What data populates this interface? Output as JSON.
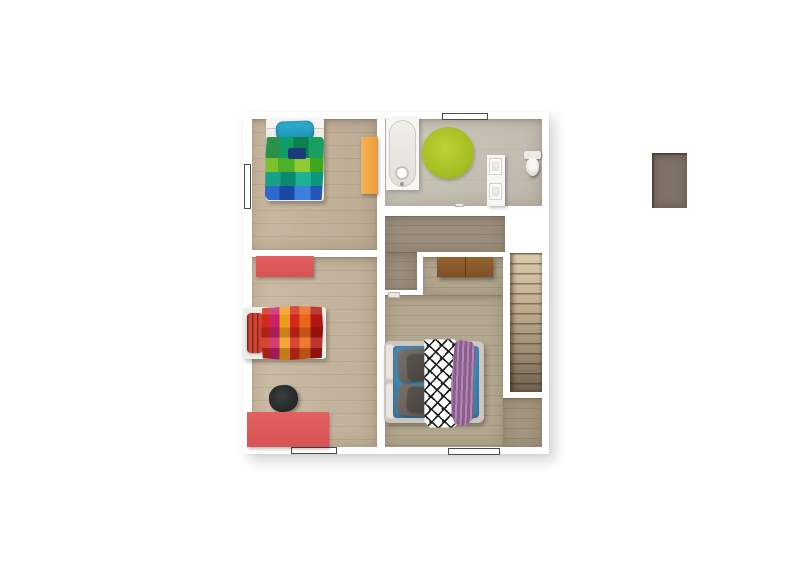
{
  "scene": {
    "description": "3D top-down architectural floor plan rendering of an upper storey, no visible text labels",
    "background_color": "#ffffff",
    "wall_color": "#ffffff",
    "rooms": [
      {
        "id": "bedroom-top-left",
        "floor_color": "#c5b49b",
        "furniture": [
          "single bed with blue-green plaid duvet",
          "teal pillow",
          "orange dresser"
        ],
        "windows": [
          "left wall"
        ]
      },
      {
        "id": "bathroom-top-right",
        "floor_color": "#c9c2b5",
        "toilet_nook_color": "#7e7268",
        "furniture": [
          "bathtub",
          "lime-green round rug",
          "double-basin vanity",
          "toilet"
        ],
        "windows": [
          "top wall"
        ]
      },
      {
        "id": "bedroom-bottom-left",
        "floor_color": "#c9b8a0",
        "furniture": [
          "bed with red-orange-magenta plaid duvet",
          "red pillow",
          "coral dresser",
          "coral desk",
          "black chair"
        ],
        "windows": [
          "bottom wall"
        ]
      },
      {
        "id": "hallway-landing",
        "floor_color": "#9a8e7c",
        "furniture": []
      },
      {
        "id": "master-bedroom-bottom-right",
        "floor_color": "#b3a78f",
        "furniture": [
          "double bed with blue duvet",
          "gray pillows",
          "black-white diamond runner",
          "purple chunky throw",
          "wooden chest"
        ],
        "windows": [
          "bottom wall"
        ]
      },
      {
        "id": "staircase-right",
        "tread_count": 14,
        "tread_colors": [
          "#ddcbad",
          "#6e604f"
        ]
      }
    ],
    "palette": {
      "floor_light_wood": "#c5b49b",
      "floor_tile": "#c9c2b5",
      "floor_hall": "#9a8e7c",
      "floor_master": "#b3a78f",
      "rug_green": "#a4bd22",
      "duvet_blue": "#4b8fb7",
      "duvet_plaid_cool": [
        "#7cc12d",
        "#0f9e68",
        "#15a287",
        "#2c68ce",
        "#1b3c7a"
      ],
      "duvet_plaid_warm": [
        "#d02a19",
        "#ca2168",
        "#f09c1b",
        "#e8671a",
        "#b31411"
      ],
      "coral_furniture": "#dd5a5f",
      "orange_dresser": "#ef9d35",
      "chest_wood": "#8a5a30",
      "throw_purple": "#9a6c9d",
      "chair_black": "#2b2e2f",
      "fixture_white": "#f7f6f3",
      "window_outline": "#4c4c4c"
    }
  }
}
